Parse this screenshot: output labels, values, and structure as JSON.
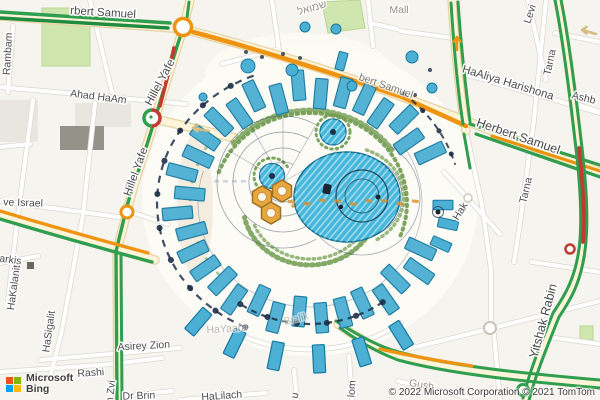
{
  "map": {
    "provider": {
      "name_line1": "Microsoft",
      "name_line2": "Bing",
      "logo_squares": [
        "#f25022",
        "#7fba00",
        "#00a4ef",
        "#ffb900"
      ]
    },
    "attribution": "© 2022 Microsoft Corporation © 2021 TomTom",
    "labels": {
      "herbert_samuel_topleft": "rbert Samuel",
      "herbert_samuel_mid": "bert Samuel",
      "herbert_samuel_right": "Herbert Samuel",
      "hillel_yafe_upper": "Hillel Yafe",
      "hillel_yafe_lower": "Hillel Yafe",
      "ahad_haam": "Ahad HaAm",
      "rambam": "Rambam",
      "mikve_israel": "ve Israel",
      "narkis": "arkis",
      "hakalanit": "HaKalanit",
      "hasigalit": "HaSigalit",
      "asirey_zion": "Asirey Zion",
      "rashi": "Rashi",
      "ben_zvi": "n Zvi",
      "dr_brin": "Dr Brin",
      "halilach": "HaLilach",
      "hayaara": "HaYaara",
      "bialik": "Bialik",
      "lom": "lom",
      "u_street": "u",
      "gush": "Gush",
      "yitshak_rabin": "Yitshak Rabin",
      "tarna_upper": "Tarna",
      "tarna_lower": "Tarna",
      "hak": "Hak",
      "haaliya_harishona": "HaAliya Harishona",
      "levi": "Levi",
      "ashb": "Ashb",
      "mall": "Mall",
      "shmuel_hebrew": "שמואל"
    },
    "colors": {
      "map_bg": "#f6f4ee",
      "road_fill": "#ffffff",
      "road_casing": "#dbd7cd",
      "arterial_fill": "#fdf4da",
      "arterial_casing": "#e7d4a4",
      "traffic_green": "#2f9e4e",
      "traffic_green_dark": "#1f8c3f",
      "traffic_orange": "#ef9412",
      "traffic_red": "#c23b33",
      "park_green": "#cfe6ae",
      "pergola_fill": "#4cb0d4",
      "pergola_stroke": "#17789f",
      "water_fill": "#45b7dc",
      "water_stroke": "#0f6f94",
      "plan_navy": "#1c2f49",
      "vegetation_green": "#6f9b4f",
      "hex_orange": "#e9a63e",
      "building_light": "#e9e6df",
      "building_dark": "#95928a",
      "label_color": "#4d4d4d",
      "label_gray": "#948f86"
    }
  }
}
